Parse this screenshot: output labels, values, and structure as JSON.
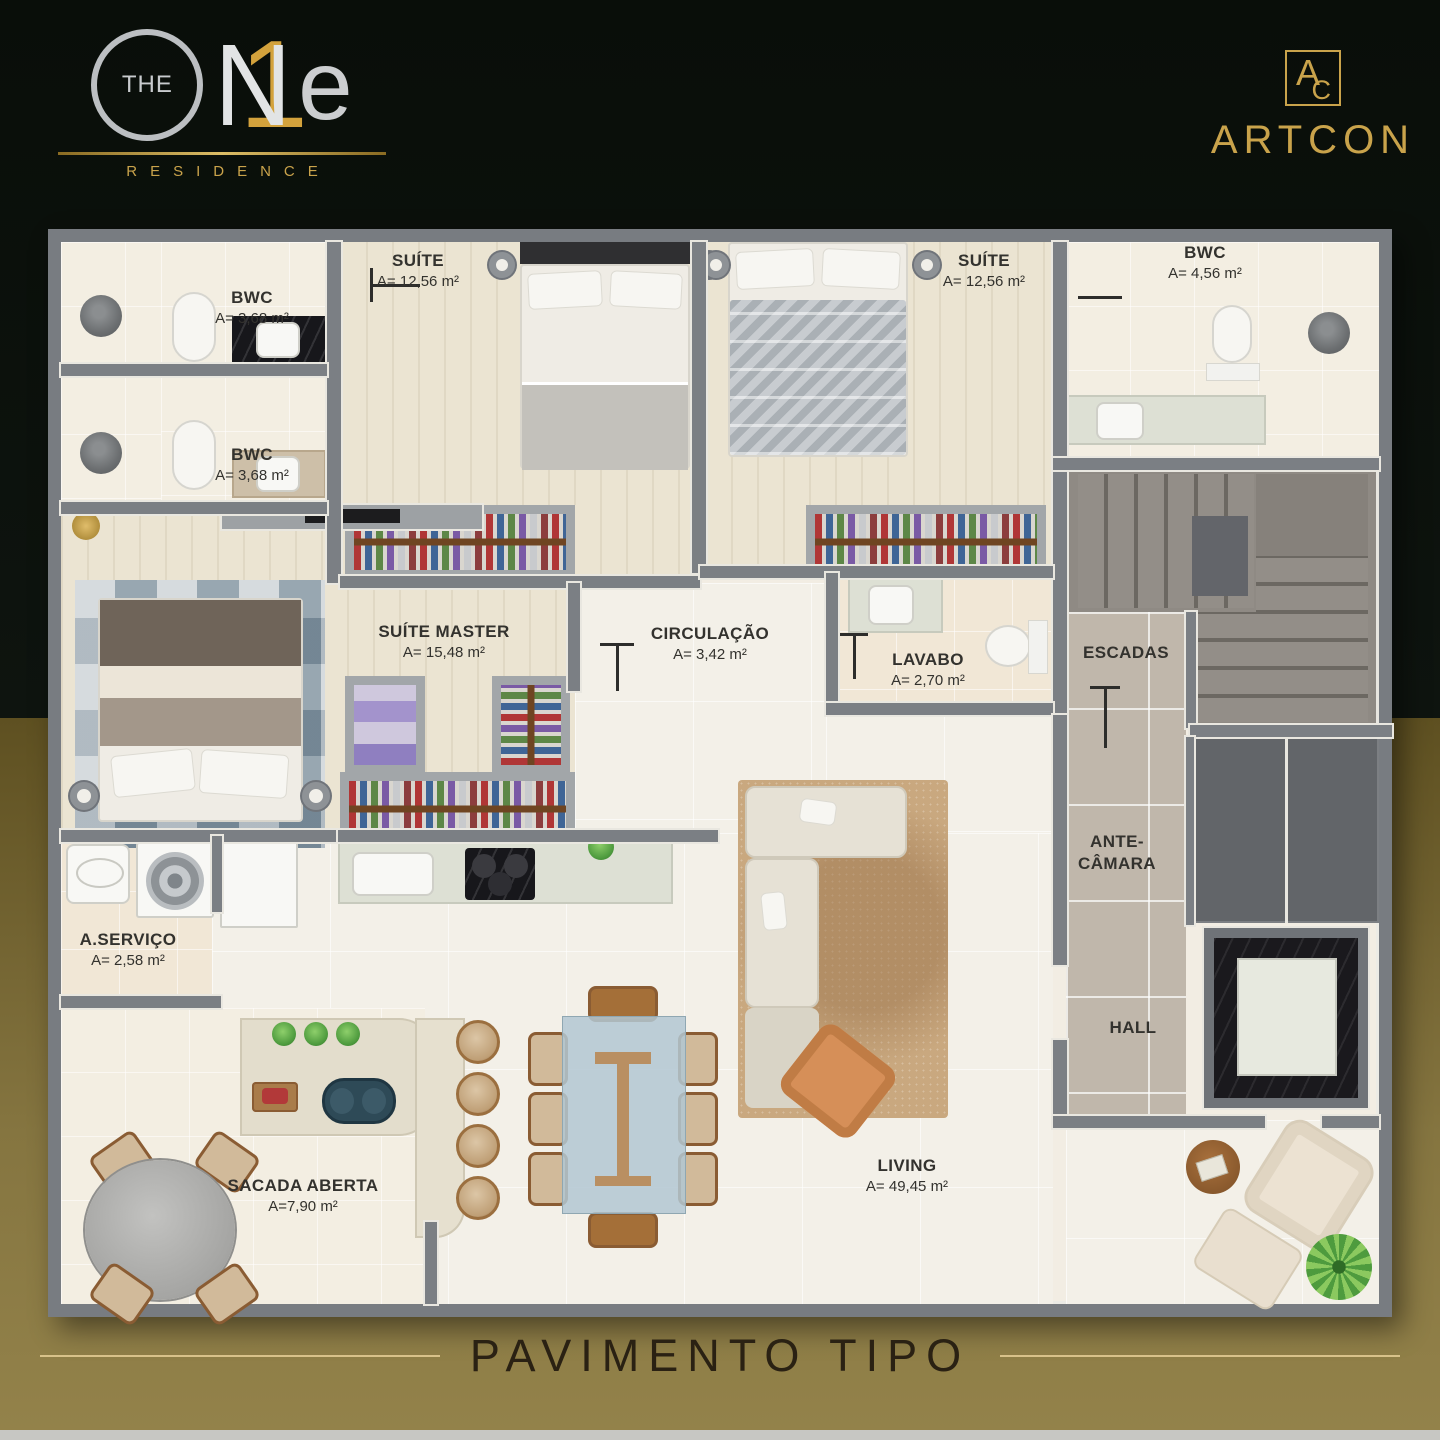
{
  "brand": {
    "pre": "THE",
    "letter_n": "N",
    "digit": "1",
    "letter_e": "e",
    "sub": "RESIDENCE"
  },
  "developer": {
    "monogram_a": "A",
    "monogram_c": "C",
    "name": "ARTCON"
  },
  "footer": {
    "title": "PAVIMENTO TIPO"
  },
  "rooms": {
    "bwc1": {
      "name": "BWC",
      "area": "A= 3,68 m²"
    },
    "bwc2": {
      "name": "BWC",
      "area": "A= 3,68 m²"
    },
    "suite1": {
      "name": "SUÍTE",
      "area": "A= 12,56 m²"
    },
    "suite2": {
      "name": "SUÍTE",
      "area": "A= 12,56 m²"
    },
    "bwc3": {
      "name": "BWC",
      "area": "A= 4,56 m²"
    },
    "suite_master": {
      "name": "SUÍTE MASTER",
      "area": "A= 15,48 m²"
    },
    "circulacao": {
      "name": "CIRCULAÇÃO",
      "area": "A= 3,42 m²"
    },
    "lavabo": {
      "name": "LAVABO",
      "area": "A= 2,70 m²"
    },
    "escadas": {
      "name": "ESCADAS"
    },
    "ante_camara": {
      "line1": "ANTE-",
      "line2": "CÂMARA"
    },
    "hall": {
      "name": "HALL"
    },
    "a_servico": {
      "name": "A.SERVIÇO",
      "area": "A= 2,58 m²"
    },
    "sacada": {
      "name": "SACADA ABERTA",
      "area": "A=7,90 m²"
    },
    "living": {
      "name": "LIVING",
      "area": "A= 49,45 m²"
    }
  },
  "palette": {
    "background_dark": "#0c120d",
    "background_gold": "#857540",
    "brand_gold": "#c9a34b",
    "brand_silver": "#bcbfc2",
    "wall_gray": "#7b7f84",
    "floor_cream": "#f2ede3",
    "floor_gray_tile": "#c0b7ab",
    "rug_tan": "#c9a87f",
    "label_ink": "#33322e",
    "footer_ink": "#2a2113"
  }
}
